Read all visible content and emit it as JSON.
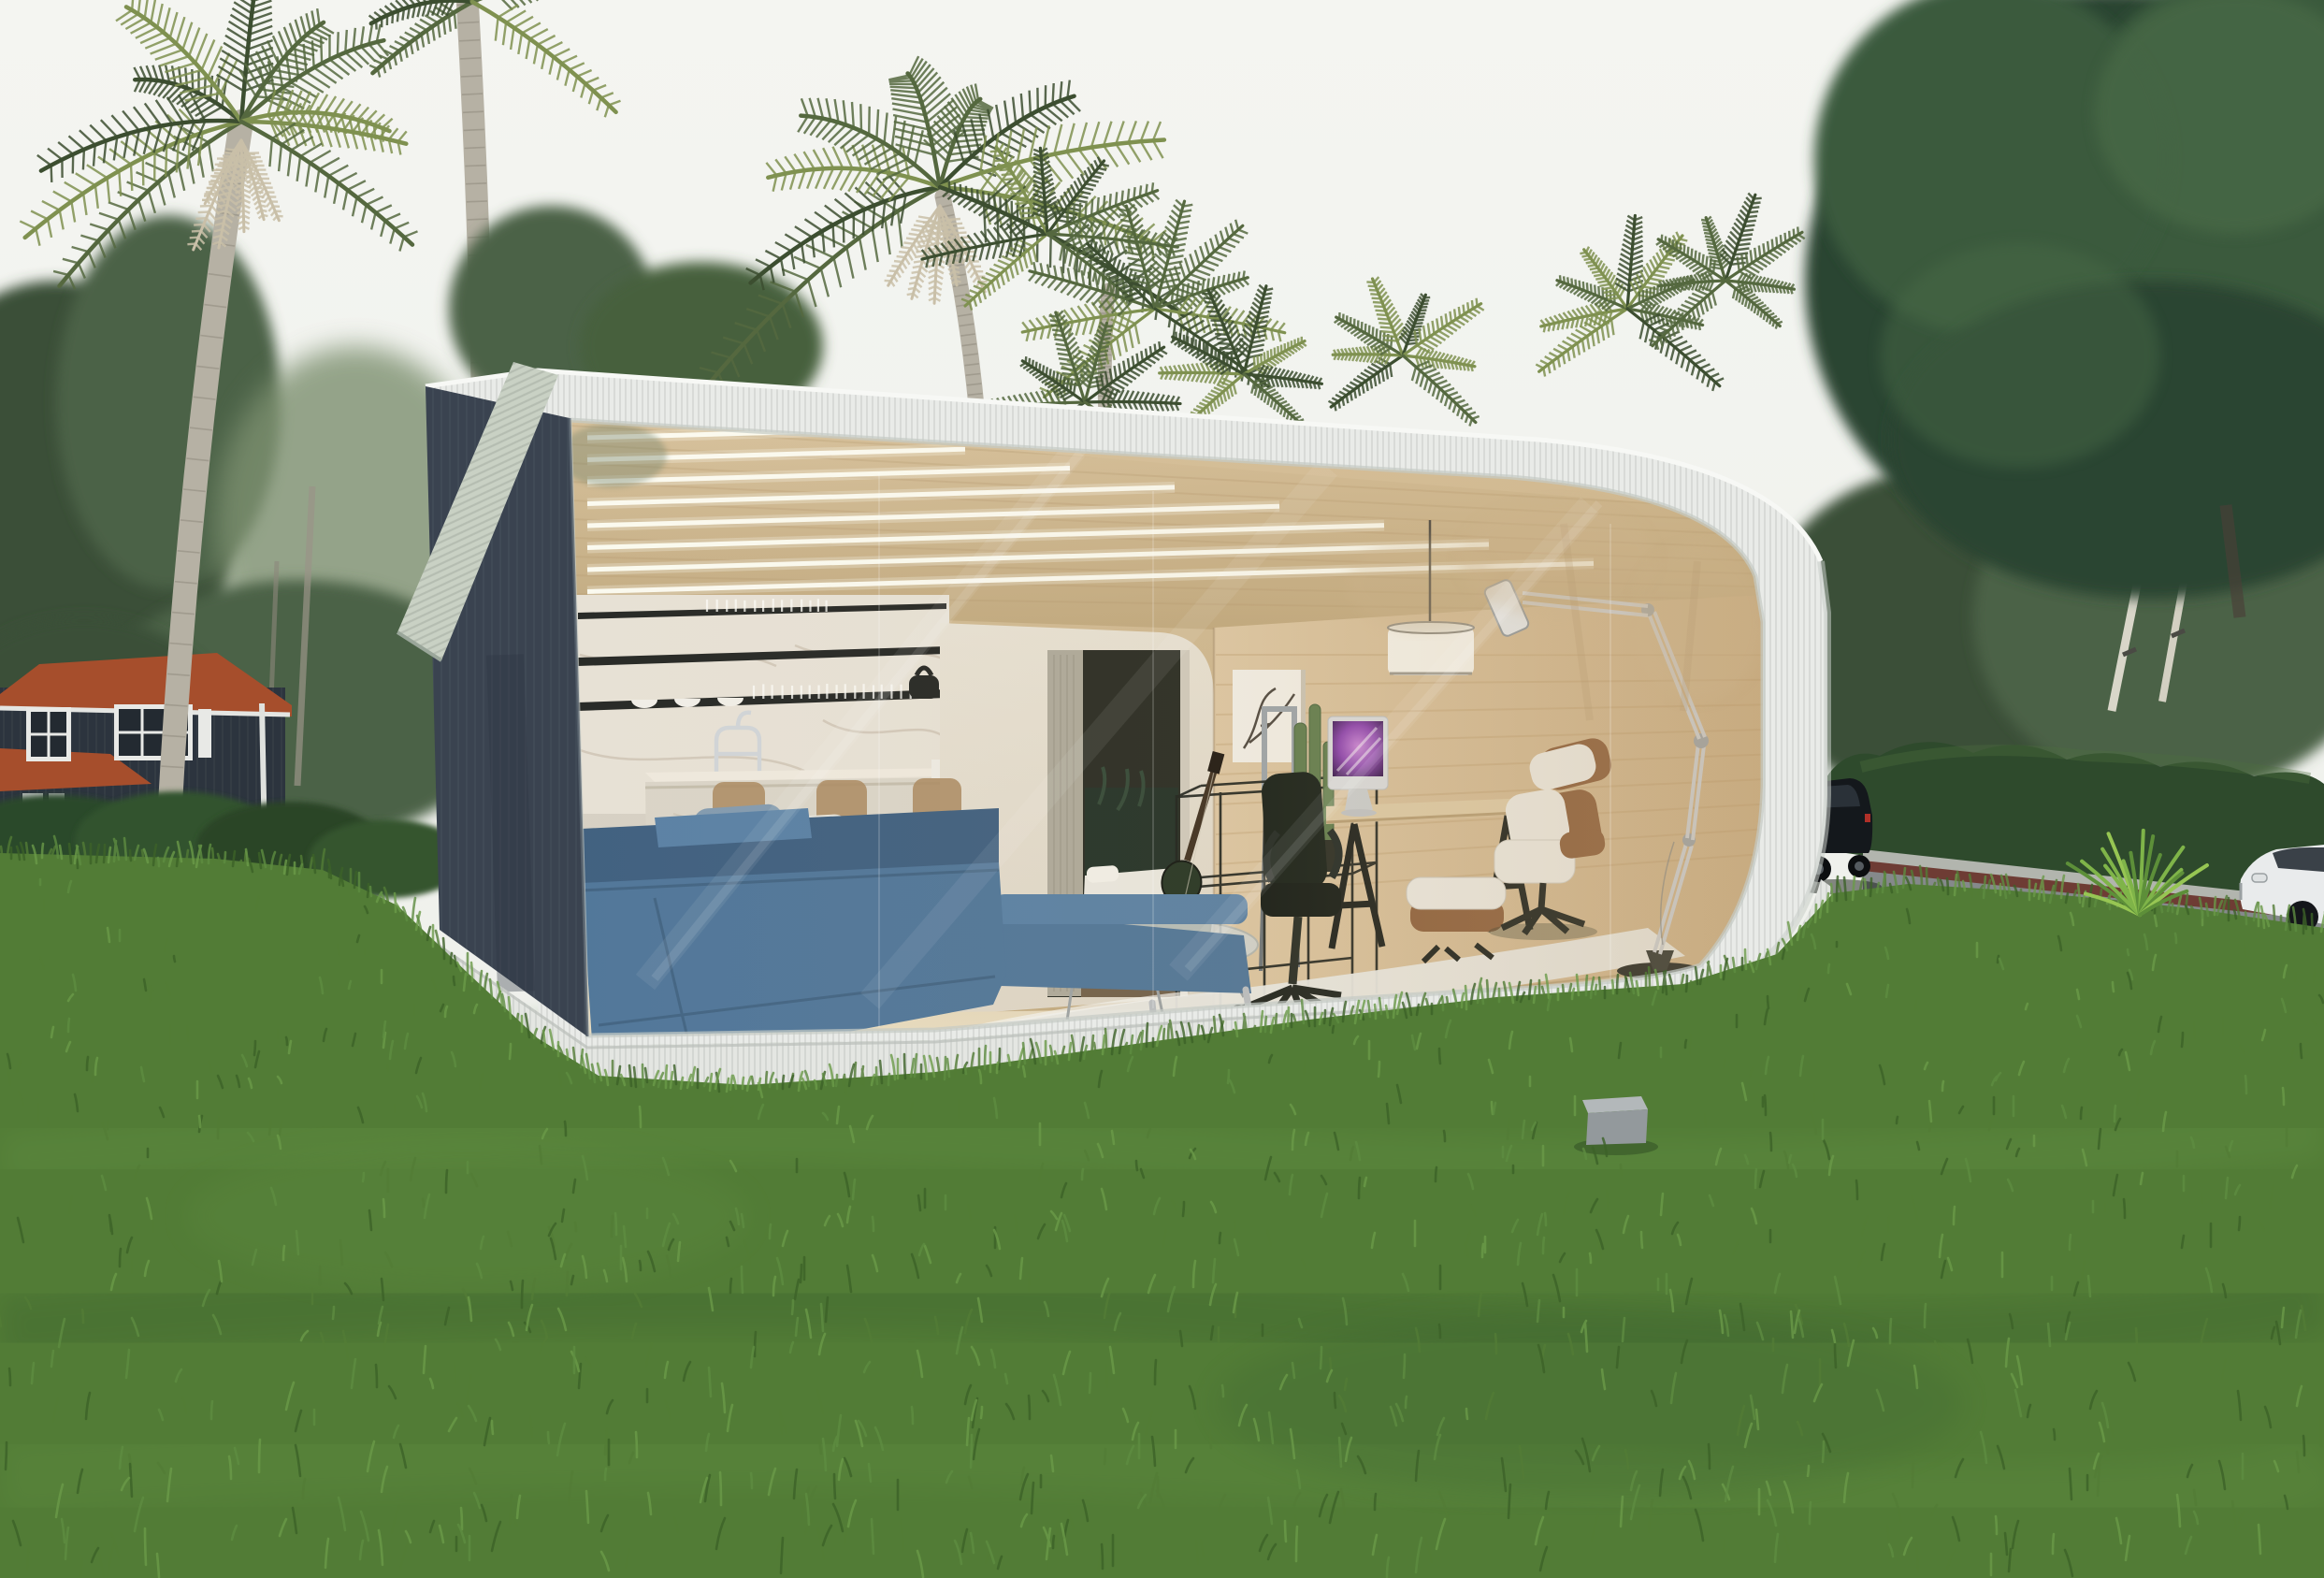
{
  "scene": {
    "type": "architectural-render",
    "description": "Photorealistic daylight rendering of a modern prefab garden office pod with a rounded white ribbed shell, charcoal side wall and full-height glass front revealing a furnished interior, placed on a large lawn with palm trees, a dark wooden house at left, a hedge-lined road with cars at right.",
    "no_visible_text": true
  },
  "colors": {
    "sky": "#f4f5f1",
    "sky_low": "#eceee9",
    "bg_tree": "#4c6246",
    "bg_tree_dark": "#3b5038",
    "bg_tree_light": "#7d9070",
    "big_tree": "#2c4530",
    "big_tree_mid": "#3a5a3c",
    "big_tree_light": "#4a6b47",
    "palm_green": "#55683f",
    "palm_green_dark": "#3c4e30",
    "palm_yellow": "#7f9150",
    "palm_trunk": "#b6b1a4",
    "palm_trunk_shadow": "#8e897c",
    "dead_frond": "#c9bfa8",
    "hedge": "#2e4a2c",
    "grass_base": "#527c36",
    "grass_light": "#6a9a49",
    "grass_dark": "#3c6128",
    "grass_far": "#79a258",
    "road": "#85898b",
    "curb_red": "#6e3c34",
    "sidewalk": "#b2b5ae",
    "car_black": "#14181c",
    "car_white": "#e9ebec",
    "house_wall": "#2c343e",
    "house_roof": "#a64e2c",
    "window_frame": "#e8e9e6",
    "window_glass": "#232a31",
    "pod_shell": "#e9ebe8",
    "pod_shell_shade": "#cfd4cf",
    "eave_band": "#c9d1c4",
    "dark_wall": "#3a4350",
    "dark_wall_deep": "#2e3642",
    "plinth": "#e4e6e2",
    "ceiling_wood": "#d6c09a",
    "ceiling_wood_deep": "#bfa77c",
    "led_white": "#fdfdf4",
    "marble": "#e6e0d4",
    "marble_vein": "#bfb3a0",
    "shelf_black": "#20221f",
    "counter_face": "#d9d3c6",
    "partition_cream": "#ddd5c5",
    "door_dark": "#23261e",
    "wood_wall": "#c8ac83",
    "wood_wall_light": "#dcc6a2",
    "wood_floor": "#d9c8a7",
    "rug": "#e7e7e2",
    "sofa_blue": "#4b7296",
    "sofa_blue_dark": "#3a5b7c",
    "pillow_gray": "#7f98ad",
    "pillow_white": "#e6e3da",
    "stool_wood": "#a8885f",
    "chrome": "#c3c7cb",
    "desk_wood": "#dcc9a4",
    "furniture_black": "#161a16",
    "imac_silver": "#d8dadc",
    "screen_purple": "#8a3fae",
    "screen_pink": "#c77fd6",
    "screen_dark": "#2c0f45",
    "eames_walnut": "#8a5c38",
    "eames_white": "#eae8e1",
    "pendant_white": "#f4f2ea",
    "guitar_dark": "#20301f",
    "art_bg": "#f1eee6",
    "cactus": "#5d7a4a",
    "reflection_warm": "#cdb48c",
    "box_gray": "#93999c",
    "box_gray_top": "#b3b8ba"
  },
  "objects": {
    "vegetation": [
      "left feather palm",
      "tall straight palm trunk",
      "center fan palm cluster",
      "large right tree",
      "background conifers",
      "hedge row",
      "lawn",
      "yucca plant",
      "foundation bushes"
    ],
    "buildings": [
      "dark wood house with terracotta roof",
      "prefab glass-front office pod"
    ],
    "pod_interior": [
      "wood slat ceiling with LED strips",
      "marble kitchen wall with shelves and glassware",
      "bridge faucet",
      "coffee machine",
      "marble island",
      "three bar stools",
      "blue sectional sofa with pillows",
      "glass coffee table",
      "white shag rug",
      "bedroom doorway with bed",
      "acoustic guitar",
      "black wire shelf rack",
      "cactus planter",
      "framed branch artwork",
      "gray easel",
      "trestle desk",
      "iMac computer",
      "black office chair",
      "Eames lounge chair and ottoman",
      "white drum pendant lamp",
      "giant chrome architect floor lamp"
    ],
    "vehicles": [
      "black SUV",
      "white sedan"
    ],
    "street": [
      "sidewalk",
      "red-brown curb",
      "asphalt road",
      "gray utility box on lawn"
    ]
  }
}
